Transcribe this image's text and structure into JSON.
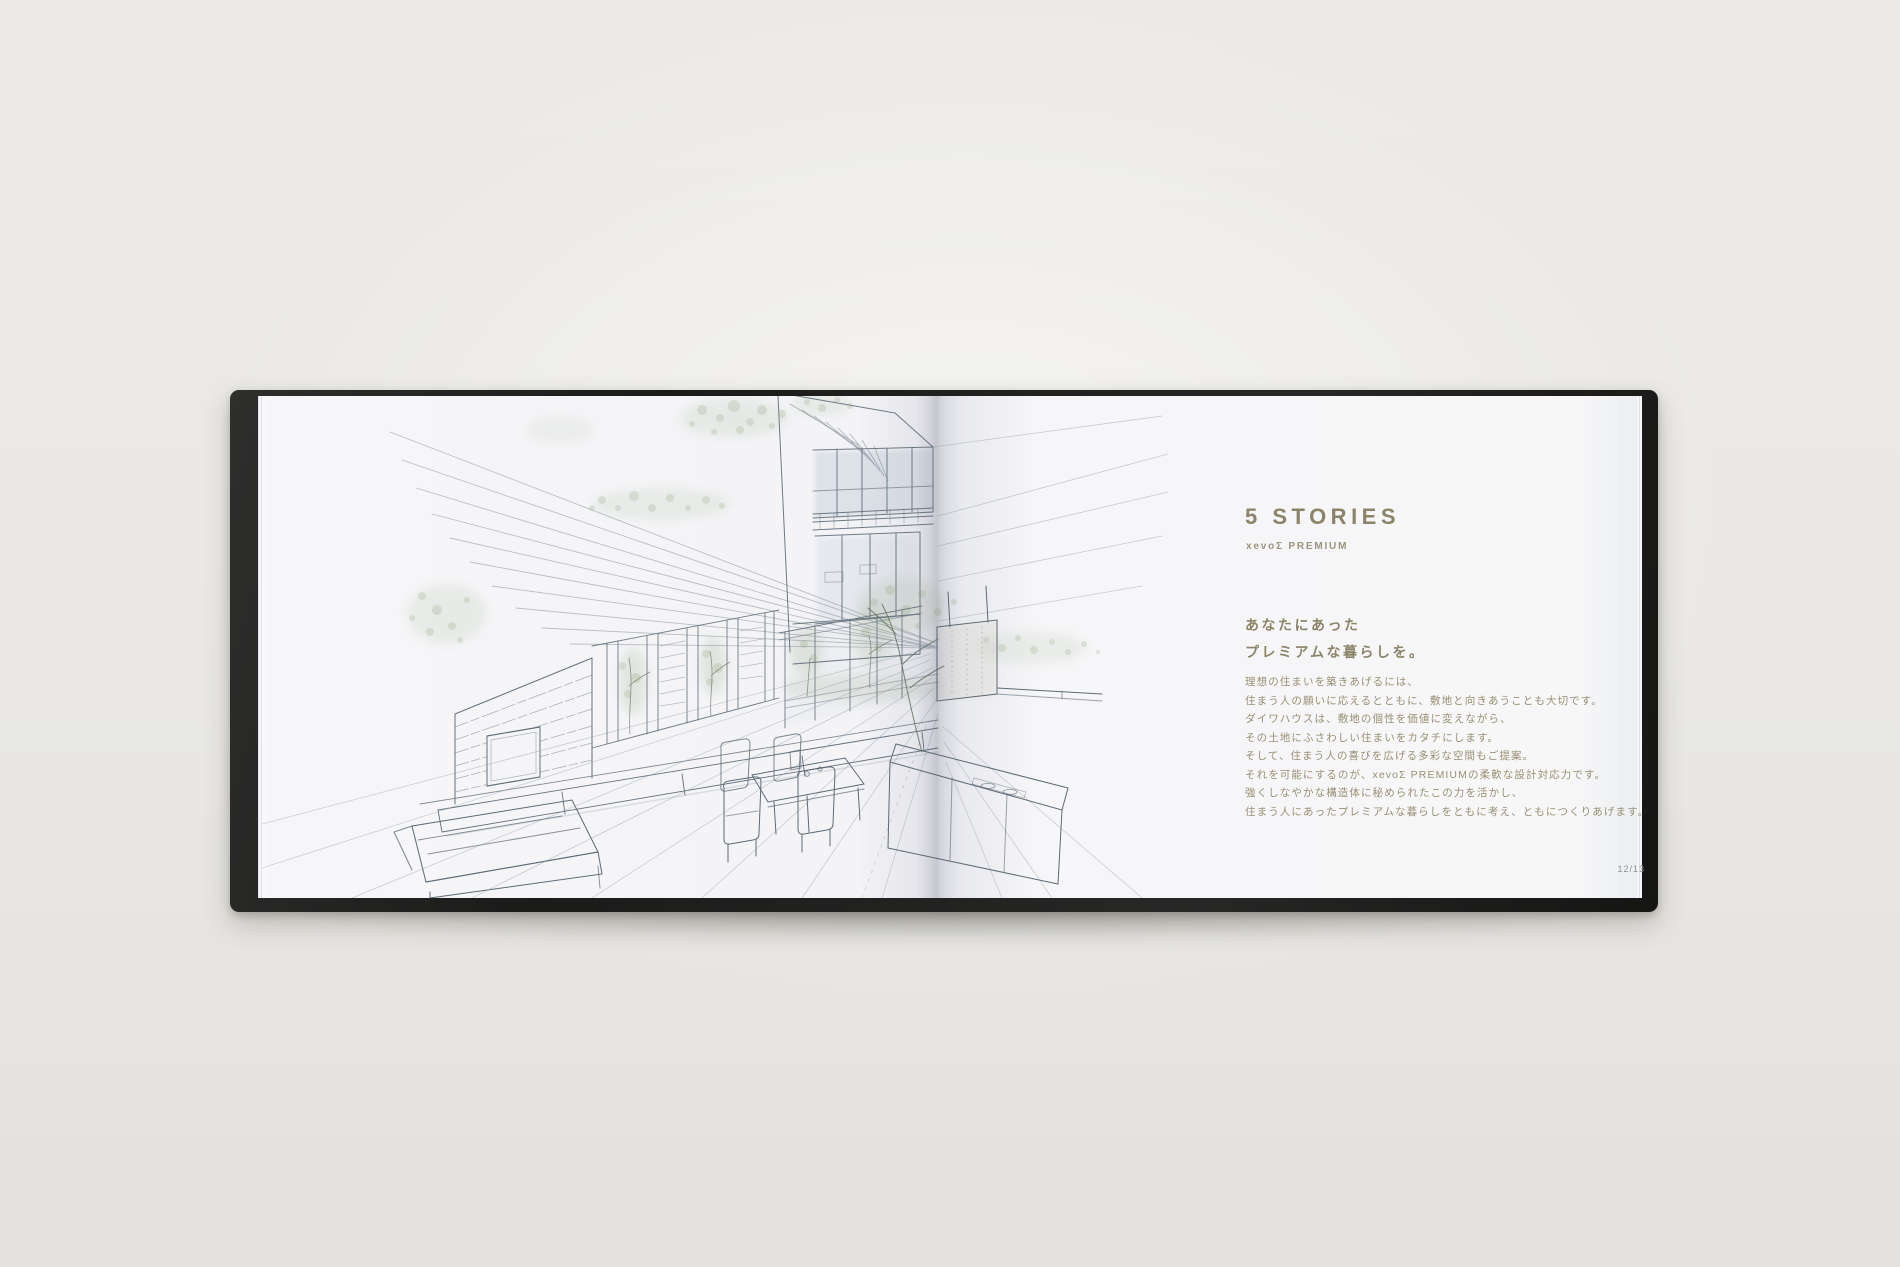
{
  "colors": {
    "background": "#e9e8e4",
    "cover": "#232322",
    "page": "#f5f5f7",
    "accent": "#8c8468",
    "body_text": "#998f73",
    "page_number": "#8f8f8f",
    "sketch_ink": "#6e7a84",
    "sketch_green": "#8fa17c"
  },
  "book": {
    "left_page": {
      "sketch": "interior-architectural-watercolor-sketch"
    },
    "right_page": {
      "title": "5 STORIES",
      "subtitle": "xevoΣ PREMIUM",
      "lead_lines": [
        "あなたにあった",
        "プレミアムな暮らしを。"
      ],
      "body_lines": [
        "理想の住まいを築きあげるには、",
        "住まう人の願いに応えるとともに、敷地と向きあうことも大切です。",
        "ダイワハウスは、敷地の個性を価値に変えながら、",
        "その土地にふさわしい住まいをカタチにします。",
        "そして、住まう人の喜びを広げる多彩な空間もご提案。",
        "それを可能にするのが、xevoΣ PREMIUMの柔軟な設計対応力です。",
        "強くしなやかな構造体に秘められたこの力を活かし、",
        "住まう人にあったプレミアムな暮らしをともに考え、ともにつくりあげます。"
      ],
      "page_number": "12/13"
    }
  }
}
